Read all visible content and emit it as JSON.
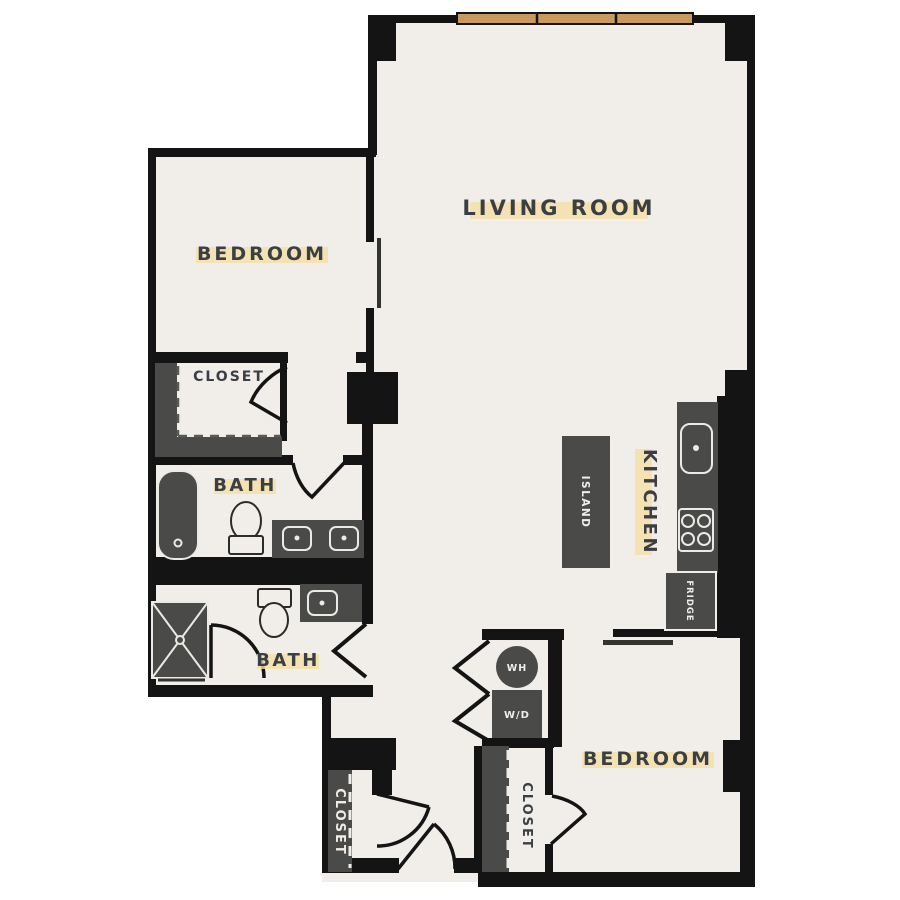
{
  "floor_plan": {
    "labels": {
      "living_room": "LIVING ROOM",
      "bedroom_upper": "BEDROOM",
      "bedroom_lower": "BEDROOM",
      "bath_upper": "BATH",
      "bath_lower": "BATH",
      "kitchen": "KITCHEN",
      "closet_bedroom_upper": "CLOSET",
      "closet_bedroom_lower": "CLOSET",
      "closet_entry": "CLOSET",
      "island": "ISLAND",
      "fridge": "FRIDGE",
      "water_heater": "WH",
      "washer_dryer": "W/D"
    },
    "fixtures": [
      "bathtub",
      "toilet-upper-bath",
      "double-vanity-sinks",
      "shower",
      "toilet-lower-bath",
      "single-vanity-sink",
      "kitchen-sink",
      "cooktop",
      "fridge",
      "kitchen-island",
      "water-heater",
      "washer-dryer",
      "windows"
    ],
    "colors": {
      "wall": "#141414",
      "floor": "#f1eeea",
      "outside": "#ffffff",
      "fixture_dark": "#4a4a48",
      "window_tan": "#c9995f",
      "label_text": "#3a3e45",
      "label_highlight": "#f6dfa4"
    }
  }
}
